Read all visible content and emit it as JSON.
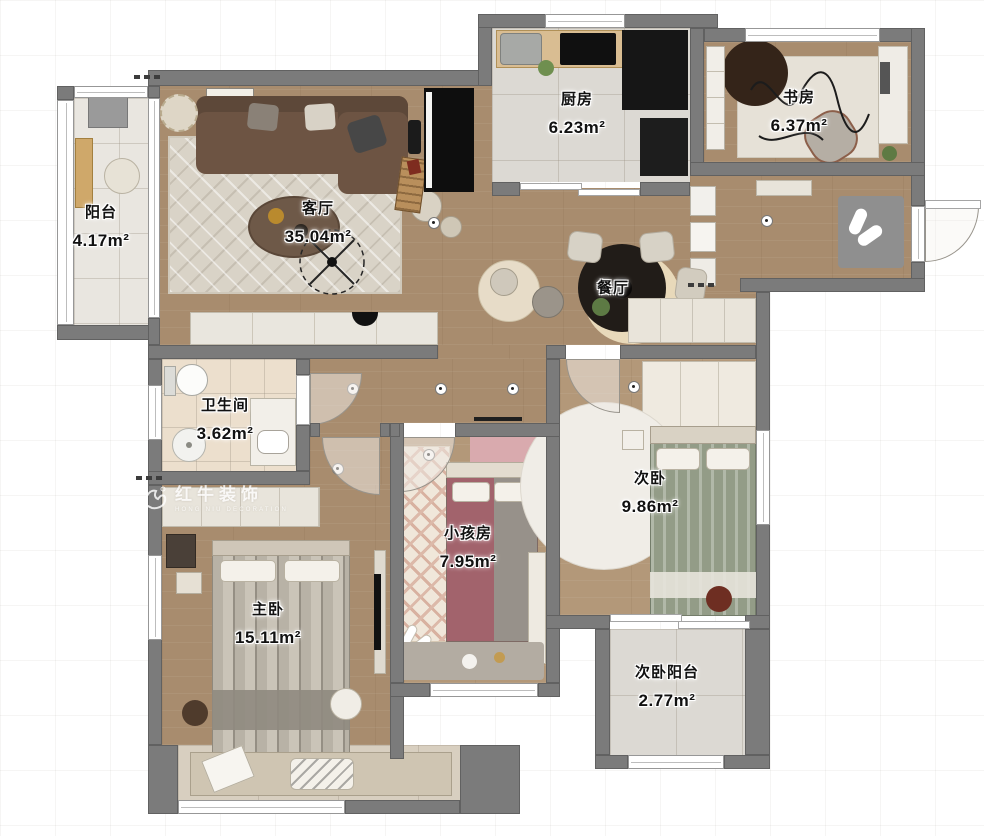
{
  "brand": {
    "name": "红牛装饰",
    "subtitle": "HONG NIU DECORATION"
  },
  "rooms": [
    {
      "key": "balcony",
      "name": "阳台",
      "area": "4.17m²"
    },
    {
      "key": "living-room",
      "name": "客厅",
      "area": "35.04m²"
    },
    {
      "key": "kitchen",
      "name": "厨房",
      "area": "6.23m²"
    },
    {
      "key": "study",
      "name": "书房",
      "area": "6.37m²"
    },
    {
      "key": "dining-room",
      "name": "餐厅",
      "area": ""
    },
    {
      "key": "bathroom",
      "name": "卫生间",
      "area": "3.62m²"
    },
    {
      "key": "second-bedroom",
      "name": "次卧",
      "area": "9.86m²"
    },
    {
      "key": "kids-room",
      "name": "小孩房",
      "area": "7.95m²"
    },
    {
      "key": "master-bedroom",
      "name": "主卧",
      "area": "15.11m²"
    },
    {
      "key": "second-balcony",
      "name": "次卧阳台",
      "area": "2.77m²"
    }
  ],
  "colors": {
    "wall": "#7b7b7b",
    "wood_floor": "#a88c6e",
    "tile_floor": "#e9e6e0",
    "sofa_brown": "#6d5443",
    "accent_pink": "#d9aaae",
    "appliance_black": "#161616"
  }
}
